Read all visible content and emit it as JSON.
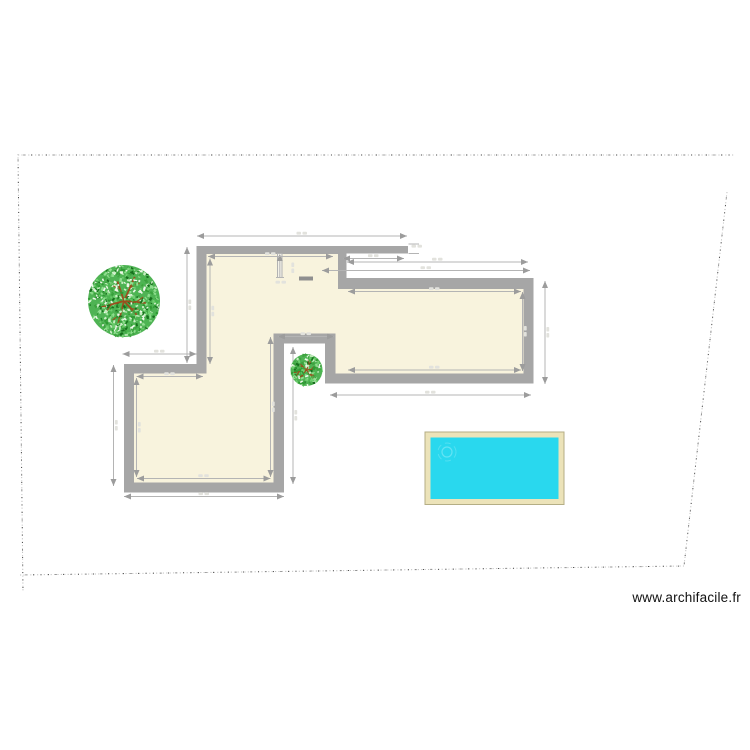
{
  "watermark": {
    "text": "www.archifacile.fr"
  },
  "canvas": {
    "width": 750,
    "height": 750
  },
  "colors": {
    "background": "#ffffff",
    "wall": "#a6a6a6",
    "floor": "#f8f3dd",
    "dim_line": "#b4b4b4",
    "dim_arrow": "#9c9c9c",
    "dim_label": "#e2e2dd",
    "boundary_light": "#c2c2c2",
    "boundary_dark": "#4a4a4a",
    "door_marker": "#8f8f8f",
    "partition_fill": "#f3f1e8",
    "partition_stroke": "#b2b2b2",
    "pool_water": "#29d8ee",
    "pool_deck": "#ece3b9",
    "pool_edge": "#b4ae85",
    "pool_ripple": "#7ce8f6",
    "tree_base": "#4fb354",
    "tree_branch": "#9a4f1e",
    "tree_leaves": [
      "#2f9a33",
      "#6fcf6f",
      "#c9eec3",
      "#17701d",
      "#49b84e",
      "#eef8ea",
      "#3da33f",
      "#8fdd8e"
    ]
  },
  "boundary": {
    "segments": [
      [
        18,
        155,
        735,
        155
      ],
      [
        18,
        154,
        23,
        592
      ],
      [
        20,
        575,
        684,
        566
      ],
      [
        727,
        192,
        684,
        566
      ]
    ]
  },
  "building": {
    "outer": [
      [
        196.5,
        246
      ],
      [
        408,
        246
      ],
      [
        408,
        253.5
      ],
      [
        346.5,
        253.5
      ],
      [
        346.5,
        278
      ],
      [
        533.5,
        278
      ],
      [
        533.5,
        383.5
      ],
      [
        325,
        383.5
      ],
      [
        325,
        343.5
      ],
      [
        284,
        343.5
      ],
      [
        284,
        492.5
      ],
      [
        124,
        492.5
      ],
      [
        124,
        364
      ],
      [
        196.5,
        364
      ]
    ],
    "inner": [
      [
        206.5,
        254
      ],
      [
        338,
        254
      ],
      [
        338,
        289
      ],
      [
        523.5,
        289
      ],
      [
        523.5,
        373.5
      ],
      [
        335.5,
        373.5
      ],
      [
        335.5,
        333.5
      ],
      [
        273.5,
        333.5
      ],
      [
        273.5,
        482.5
      ],
      [
        134,
        482.5
      ],
      [
        134,
        373.5
      ],
      [
        206.5,
        373.5
      ]
    ]
  },
  "partition": {
    "x": 277.5,
    "y": 253.5,
    "w": 4.5,
    "h": 24,
    "dim_x": 279.8,
    "dim_y1": 255,
    "dim_y2": 277.5,
    "tick": [
      276,
      277.5,
      284,
      277.5
    ]
  },
  "door_marker": {
    "x": 299,
    "y": 276.5,
    "w": 14,
    "h": 4
  },
  "dimensions": [
    [
      197,
      236,
      407,
      236
    ],
    [
      208,
      256.5,
      333,
      256.5
    ],
    [
      343,
      258.5,
      404,
      258.5
    ],
    [
      347,
      262,
      528,
      262
    ],
    [
      322,
      270.5,
      530,
      270.5
    ],
    [
      348,
      291.5,
      521,
      291.5
    ],
    [
      348,
      370,
      521,
      370
    ],
    [
      330,
      395,
      531,
      395
    ],
    [
      278,
      336.5,
      334,
      336.5
    ],
    [
      122.5,
      354,
      196.5,
      354
    ],
    [
      124,
      496.5,
      284,
      496.5
    ],
    [
      137,
      478.5,
      270.5,
      478.5
    ],
    [
      136.5,
      376.5,
      203,
      376.5
    ],
    [
      187,
      247,
      187,
      363
    ],
    [
      210,
      258.5,
      210,
      364
    ],
    [
      113.5,
      365,
      113.5,
      486
    ],
    [
      136.5,
      378,
      136.5,
      477
    ],
    [
      270.5,
      337,
      270.5,
      477
    ],
    [
      293,
      347,
      293,
      484
    ],
    [
      545,
      281,
      545,
      384
    ],
    [
      522.5,
      292,
      522.5,
      371
    ]
  ],
  "extension_ticks": [
    [
      408.5,
      244,
      419,
      244
    ],
    [
      408.5,
      253.5,
      419,
      253.5
    ]
  ],
  "extra_labels": [
    {
      "x": 417,
      "y": 249,
      "vertical": false
    },
    {
      "x": 290,
      "y": 268,
      "vertical": true
    },
    {
      "x": 281,
      "y": 285,
      "vertical": false
    }
  ],
  "trees": [
    {
      "name": "tree-large",
      "cx": 124,
      "cy": 301,
      "r": 36,
      "seed": 7,
      "leaves": 560
    },
    {
      "name": "tree-small",
      "cx": 306.5,
      "cy": 370,
      "r": 16,
      "seed": 13,
      "leaves": 140
    }
  ],
  "pool": {
    "x": 425,
    "y": 432,
    "w": 139,
    "h": 72.5,
    "inset": 5.5,
    "ripple_cx": 447,
    "ripple_cy": 452,
    "ripple_r1": 5,
    "ripple_r2": 9
  }
}
